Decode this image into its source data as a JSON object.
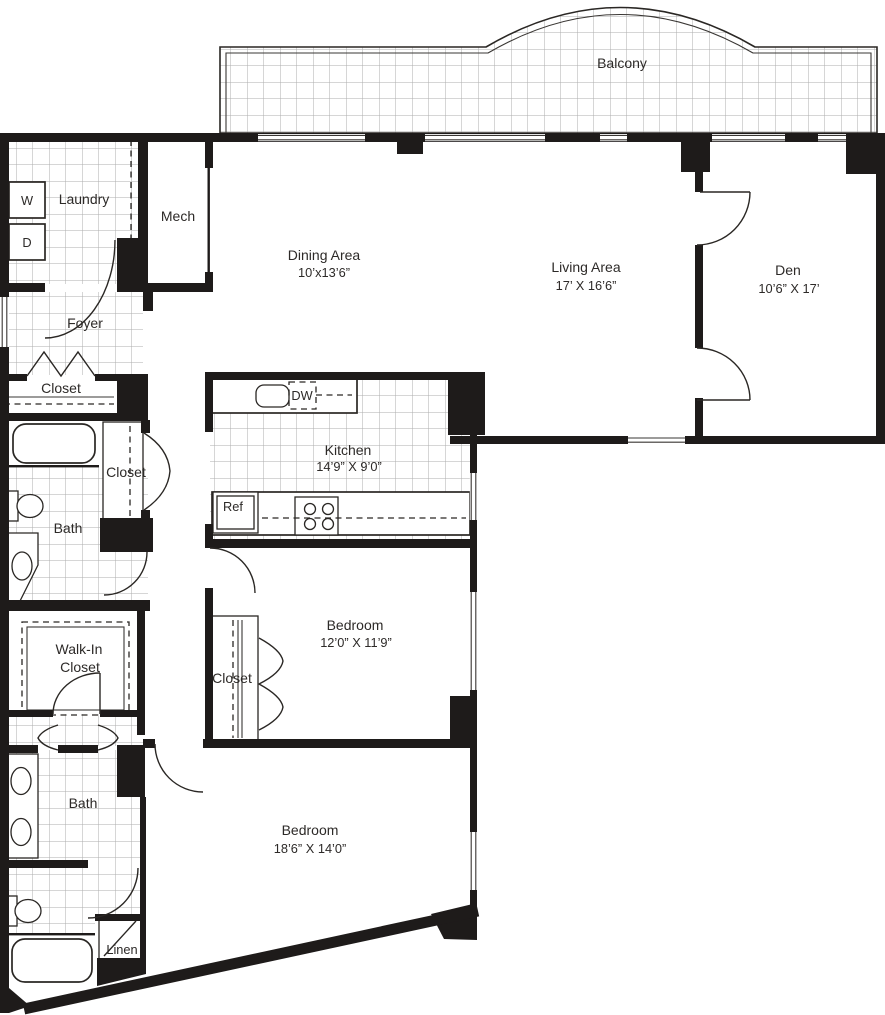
{
  "floorplan": {
    "balcony": {
      "label": "Balcony"
    },
    "laundry": {
      "label": "Laundry",
      "washer": "W",
      "dryer": "D"
    },
    "mech": {
      "label": "Mech"
    },
    "dining": {
      "label": "Dining Area",
      "dims": "10’x13’6”"
    },
    "living": {
      "label": "Living Area",
      "dims": "17’ X 16’6”"
    },
    "den": {
      "label": "Den",
      "dims": "10’6” X 17’"
    },
    "foyer": {
      "label": "Foyer"
    },
    "foyer_closet": {
      "label": "Closet"
    },
    "hall_closet": {
      "label": "Closet"
    },
    "bath_upper": {
      "label": "Bath"
    },
    "kitchen": {
      "label": "Kitchen",
      "dims": "14’9” X 9’0”",
      "dishwasher": "DW",
      "refrigerator": "Ref"
    },
    "walk_in_closet": {
      "line1": "Walk-In",
      "line2": "Closet"
    },
    "bedroom_mid": {
      "label": "Bedroom",
      "dims": "12’0” X 11’9”"
    },
    "bedroom_mid_closet": {
      "label": "Closet"
    },
    "bath_lower": {
      "label": "Bath"
    },
    "bedroom_lower": {
      "label": "Bedroom",
      "dims": "18’6” X 14’0”"
    },
    "linen": {
      "label": "Linen"
    }
  }
}
